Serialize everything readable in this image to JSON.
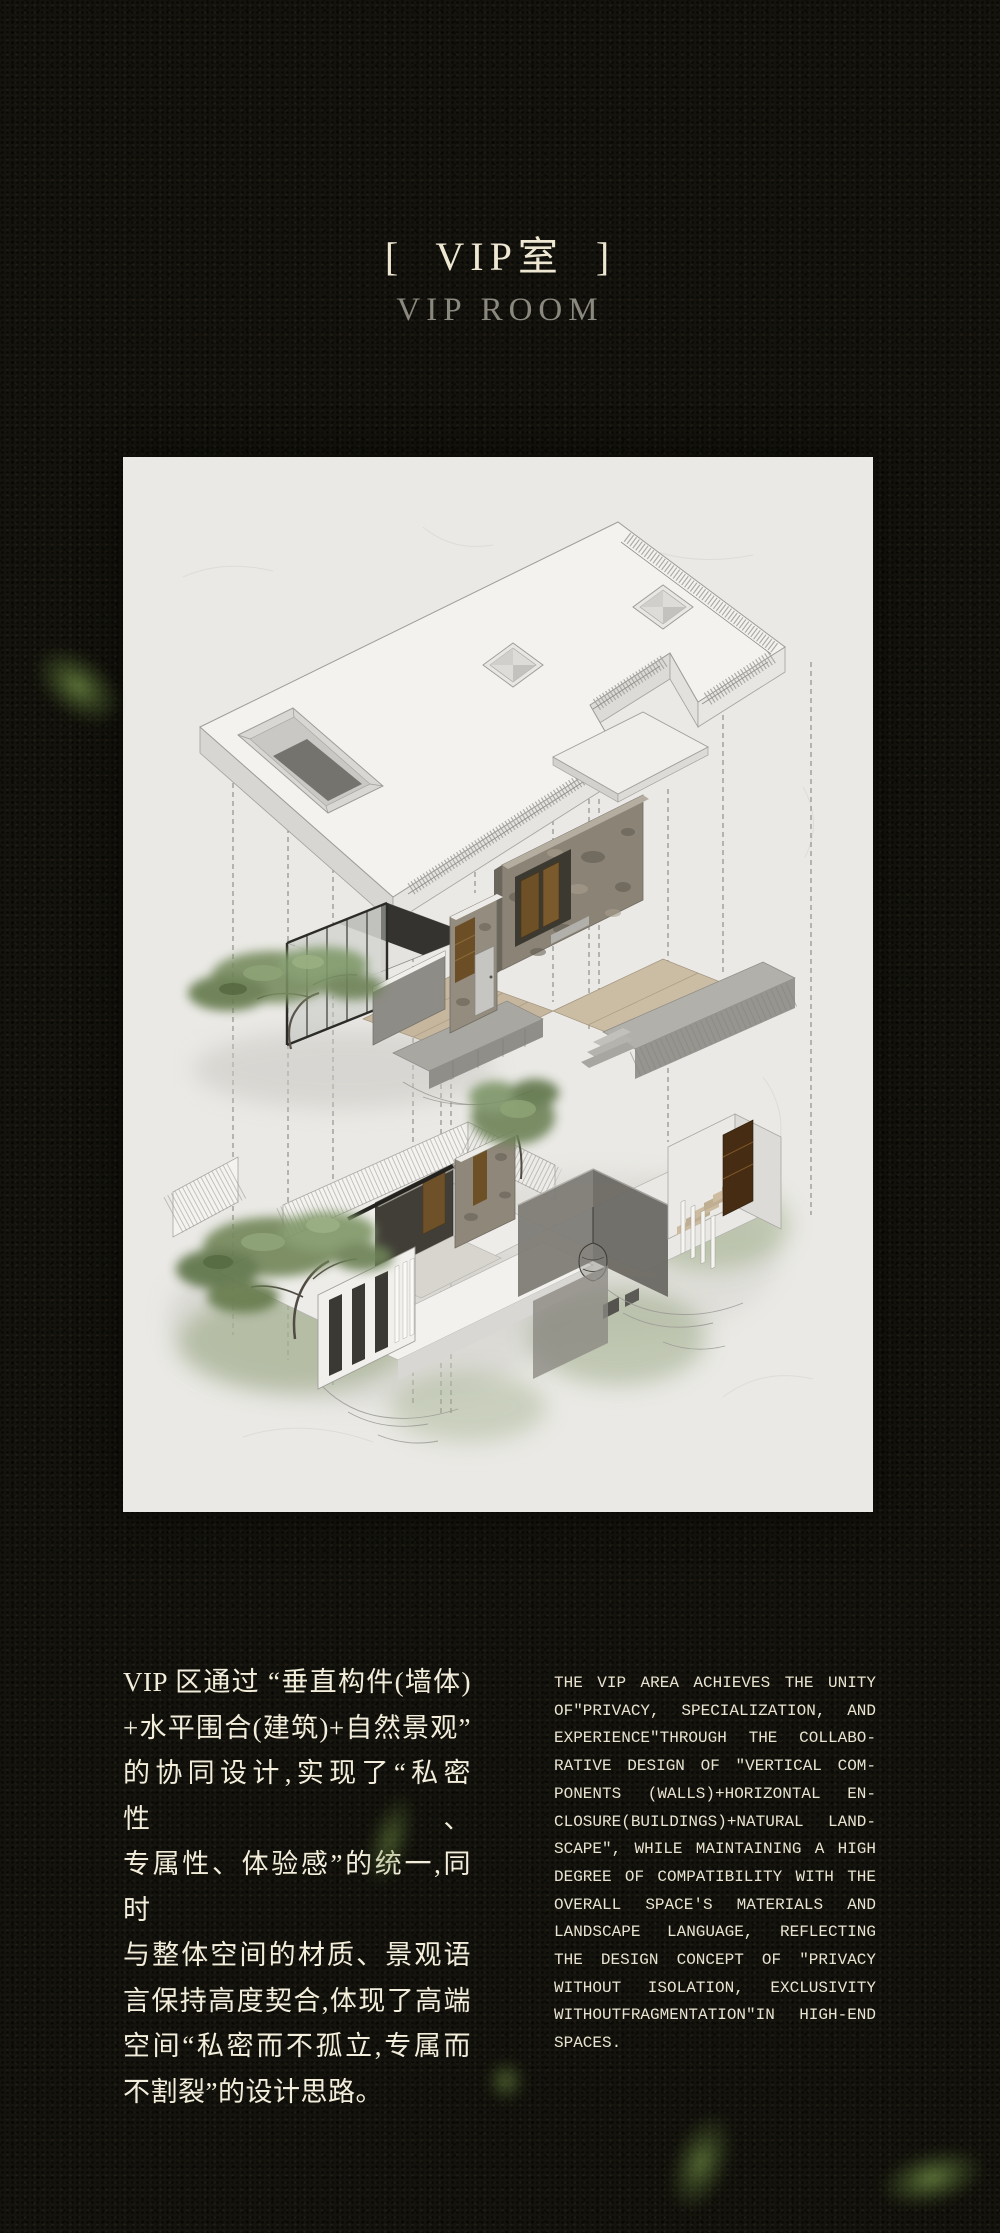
{
  "poster": {
    "background_color": "#14130d",
    "header": {
      "title_cn": "[  VIP室  ]",
      "title_en": "VIP ROOM",
      "title_cn_color": "#eee7d2",
      "title_en_color": "#8b897f"
    },
    "drawing_panel": {
      "type": "exploded-axonometric-architectural-drawing",
      "paper_color": "#eae9e5",
      "components": [
        "roof-slab-with-skylights",
        "recessed-skylight-opening",
        "glass-railing-parapet",
        "dropped-ceiling-panel",
        "floating-stone-feature-wall",
        "glass-tea-pavilion",
        "wood-deck-walkway",
        "stone-terrace",
        "ground-floor-rooms",
        "slatted-screen-wall",
        "lantern-room",
        "wood-staircase",
        "trees",
        "dashed-projection-lines"
      ],
      "palette": {
        "line": "#9e9d98",
        "slab_top": "#f3f2ef",
        "slab_side": "#d7d6d2",
        "stone": "#8b8376",
        "wood_accent": "#6e5026",
        "deck_wood": "#c6b69d",
        "dark_frame": "#34332f",
        "foliage": "#74885c"
      }
    },
    "body": {
      "text_color_cn": "#f3eedb",
      "text_color_en": "#e9e4d1",
      "chinese_lines": [
        "VIP 区通过 “垂直构件(墙体)",
        "+水平围合(建筑)+自然景观”",
        "的协同设计,实现了“私密性、",
        "专属性、体验感”的统一,同时",
        "与整体空间的材质、景观语",
        "言保持高度契合,体现了高端",
        "空间“私密而不孤立,专属而",
        "不割裂”的设计思路。"
      ],
      "english_lines": [
        "THE VIP AREA ACHIEVES THE UNITY",
        "OF\"PRIVACY, SPECIALIZATION, AND",
        "EXPERIENCE\"THROUGH THE COLLABO-",
        "RATIVE DESIGN OF \"VERTICAL COM-",
        "PONENTS (WALLS)+HORIZONTAL EN-",
        "CLOSURE(BUILDINGS)+NATURAL LAND-",
        "SCAPE\", WHILE MAINTAINING A HIGH",
        "DEGREE OF COMPATIBILITY WITH THE",
        "OVERALL SPACE'S MATERIALS AND",
        "LANDSCAPE LANGUAGE, REFLECTING",
        "THE DESIGN CONCEPT OF \"PRIVACY",
        "WITHOUT ISOLATION, EXCLUSIVITY",
        "WITHOUTFRAGMENTATION\"IN HIGH-END",
        "SPACES."
      ]
    },
    "decor": {
      "leaf_color": "#6f8a48",
      "leaf_count": 5
    }
  }
}
